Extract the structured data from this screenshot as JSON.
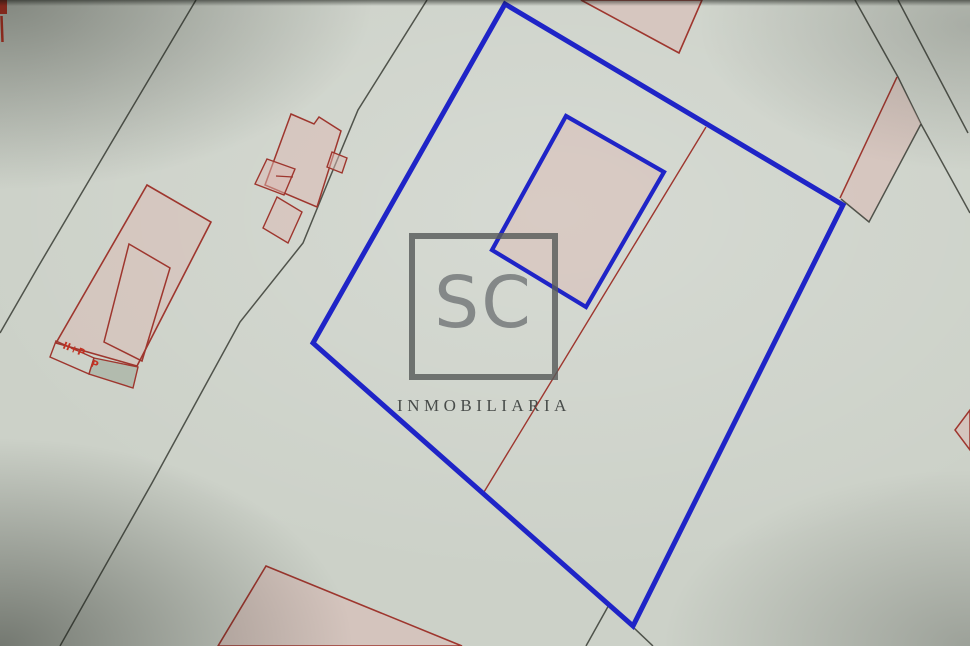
{
  "watermark": {
    "monogram": "SC",
    "subtitle": "INMOBILIARIA",
    "frame_color": "#585c5a",
    "monogram_color": "#808484",
    "subtitle_color": "#404442"
  },
  "palette": {
    "background": "#ccd1c8",
    "cadastral_black": "#41453d",
    "cadastral_red": "#9e362e",
    "bright_red": "#c23122",
    "highlight_blue": "#1f24c7",
    "building_pink": "rgba(219,183,177,0.5)",
    "annex_gray": "#b2bbae"
  },
  "map": {
    "features": [
      {
        "name": "road-left-outer-line",
        "tag": "polyline",
        "attrs": {
          "points": "196,0 110,145 38,267 0,333",
          "fill": "none",
          "stroke": "#41453d",
          "stroke-width": "1.5",
          "opacity": "0.9"
        }
      },
      {
        "name": "road-left-inner-line",
        "tag": "polyline",
        "attrs": {
          "points": "427,0 358,110 328,182 303,243 240,322 152,483 60,646",
          "fill": "none",
          "stroke": "#41453d",
          "stroke-width": "1.5",
          "opacity": "0.9"
        }
      },
      {
        "name": "road-right-inner-line",
        "tag": "polyline",
        "attrs": {
          "points": "855,0 898,77 921,124 970,213",
          "fill": "none",
          "stroke": "#41453d",
          "stroke-width": "1.5",
          "opacity": "0.9"
        }
      },
      {
        "name": "road-right-outer-line",
        "tag": "polyline",
        "attrs": {
          "points": "898,0 968,133",
          "fill": "none",
          "stroke": "#41453d",
          "stroke-width": "1.5",
          "opacity": "0.9"
        }
      },
      {
        "name": "building-top-center-fragment",
        "tag": "polygon",
        "attrs": {
          "points": "581,0 679,53 702,0",
          "fill": "rgba(219,183,177,0.5)",
          "stroke": "#9e362e",
          "stroke-width": "1.6"
        }
      },
      {
        "name": "parcel-fragment-right-fill",
        "tag": "polygon",
        "attrs": {
          "points": "897,77 921,124 869,222 840,198",
          "fill": "rgba(219,183,177,0.5)",
          "stroke": "none"
        }
      },
      {
        "name": "parcel-fragment-right-red-edge",
        "tag": "line",
        "attrs": {
          "x1": "897",
          "y1": "77",
          "x2": "840",
          "y2": "198",
          "stroke": "#9e362e",
          "stroke-width": "1.5"
        }
      },
      {
        "name": "parcel-fragment-right-black-edge",
        "tag": "polyline",
        "attrs": {
          "points": "921,124 869,222 841,199",
          "fill": "none",
          "stroke": "#41453d",
          "stroke-width": "1.5",
          "opacity": "0.9"
        }
      },
      {
        "name": "edge-mark-red-rect",
        "tag": "rect",
        "attrs": {
          "x": "0",
          "y": "0",
          "width": "7",
          "height": "14",
          "fill": "#c23122"
        }
      },
      {
        "name": "edge-mark-red-tick",
        "tag": "line",
        "attrs": {
          "x1": "1.5",
          "y1": "16",
          "x2": "2.5",
          "y2": "42",
          "stroke": "#c23122",
          "stroke-width": "2.5"
        }
      },
      {
        "name": "building-left-outer",
        "tag": "polygon",
        "attrs": {
          "points": "147,185 211,222 137,366 56,343",
          "fill": "rgba(219,183,177,0.45)",
          "stroke": "#9e362e",
          "stroke-width": "1.6"
        }
      },
      {
        "name": "building-left-inner",
        "tag": "polygon",
        "attrs": {
          "points": "129,244 170,268 142,361 104,342",
          "fill": "none",
          "stroke": "#9e362e",
          "stroke-width": "1.5"
        }
      },
      {
        "name": "building-left-strip",
        "tag": "polygon",
        "attrs": {
          "points": "56,341 94,358 89,374 50,357",
          "fill": "none",
          "stroke": "#9e362e",
          "stroke-width": "1.4"
        }
      },
      {
        "name": "building-left-annex",
        "tag": "polygon",
        "attrs": {
          "points": "94,358 138,367 133,388 89,374",
          "fill": "#b2bbae",
          "stroke": "#9e362e",
          "stroke-width": "1.4"
        }
      },
      {
        "name": "floors-label-main",
        "tag": "text",
        "attrs": {
          "x": "62",
          "y": "348",
          "fill": "#c23122",
          "font-size": "10",
          "font-family": "DejaVu Sans",
          "font-weight": "bold",
          "transform": "rotate(22 62 348)"
        },
        "text": "II+P"
      },
      {
        "name": "floors-label-annex",
        "tag": "text",
        "attrs": {
          "x": "90",
          "y": "366",
          "fill": "#c23122",
          "font-size": "10",
          "font-family": "DejaVu Sans",
          "font-weight": "bold",
          "transform": "rotate(22 90 366)"
        },
        "text": "P"
      },
      {
        "name": "building-cluster-main",
        "tag": "polygon",
        "attrs": {
          "points": "291,114 314,124 319,117 341,131 317,207 265,185",
          "fill": "rgba(219,183,177,0.5)",
          "stroke": "#9e362e",
          "stroke-width": "1.5"
        }
      },
      {
        "name": "building-cluster-tab",
        "tag": "polygon",
        "attrs": {
          "points": "332,152 347,158 342,173 327,167",
          "fill": "rgba(219,183,177,0.5)",
          "stroke": "#9e362e",
          "stroke-width": "1.4"
        }
      },
      {
        "name": "building-cluster-left",
        "tag": "polygon",
        "attrs": {
          "points": "267,159 295,169 284,195 255,184",
          "fill": "rgba(219,183,177,0.5)",
          "stroke": "#9e362e",
          "stroke-width": "1.4"
        }
      },
      {
        "name": "building-cluster-left-tick",
        "tag": "line",
        "attrs": {
          "x1": "276",
          "y1": "176",
          "x2": "293",
          "y2": "177",
          "stroke": "#9e362e",
          "stroke-width": "1.3"
        }
      },
      {
        "name": "building-cluster-lower",
        "tag": "polygon",
        "attrs": {
          "points": "277,197 302,212 288,243 263,228",
          "fill": "rgba(219,183,177,0.5)",
          "stroke": "#9e362e",
          "stroke-width": "1.4"
        }
      },
      {
        "name": "building-bottom-center",
        "tag": "polygon",
        "attrs": {
          "points": "266,566 462,646 218,646",
          "fill": "rgba(219,183,177,0.5)",
          "stroke": "#9e362e",
          "stroke-width": "1.6"
        }
      },
      {
        "name": "building-bottom-right-fragment",
        "tag": "polygon",
        "attrs": {
          "points": "970,410 955,430 970,450",
          "fill": "rgba(219,183,177,0.5)",
          "stroke": "#9e362e",
          "stroke-width": "1.5"
        }
      },
      {
        "name": "boundary-red-diagonal",
        "tag": "line",
        "attrs": {
          "x1": "706",
          "y1": "127",
          "x2": "484",
          "y2": "492",
          "stroke": "#9e362e",
          "stroke-width": "1.4"
        }
      },
      {
        "name": "boundary-stub-left",
        "tag": "line",
        "attrs": {
          "x1": "610",
          "y1": "603",
          "x2": "586",
          "y2": "646",
          "stroke": "#41453d",
          "stroke-width": "1.5",
          "opacity": "0.9"
        }
      },
      {
        "name": "boundary-stub-right",
        "tag": "line",
        "attrs": {
          "x1": "634",
          "y1": "628",
          "x2": "653",
          "y2": "646",
          "stroke": "#41453d",
          "stroke-width": "1.5",
          "opacity": "0.9"
        }
      },
      {
        "name": "parcel-highlight-blue",
        "tag": "polygon",
        "attrs": {
          "points": "505,4 843,205 633,626 313,343",
          "fill": "none",
          "stroke": "#1f24c7",
          "stroke-width": "5",
          "stroke-linejoin": "miter"
        }
      },
      {
        "name": "building-highlight-blue",
        "tag": "polygon",
        "attrs": {
          "points": "566,116 664,172 586,307 492,250",
          "fill": "rgba(219,183,177,0.45)",
          "stroke": "#1f24c7",
          "stroke-width": "4.2",
          "stroke-linejoin": "miter"
        }
      }
    ]
  }
}
